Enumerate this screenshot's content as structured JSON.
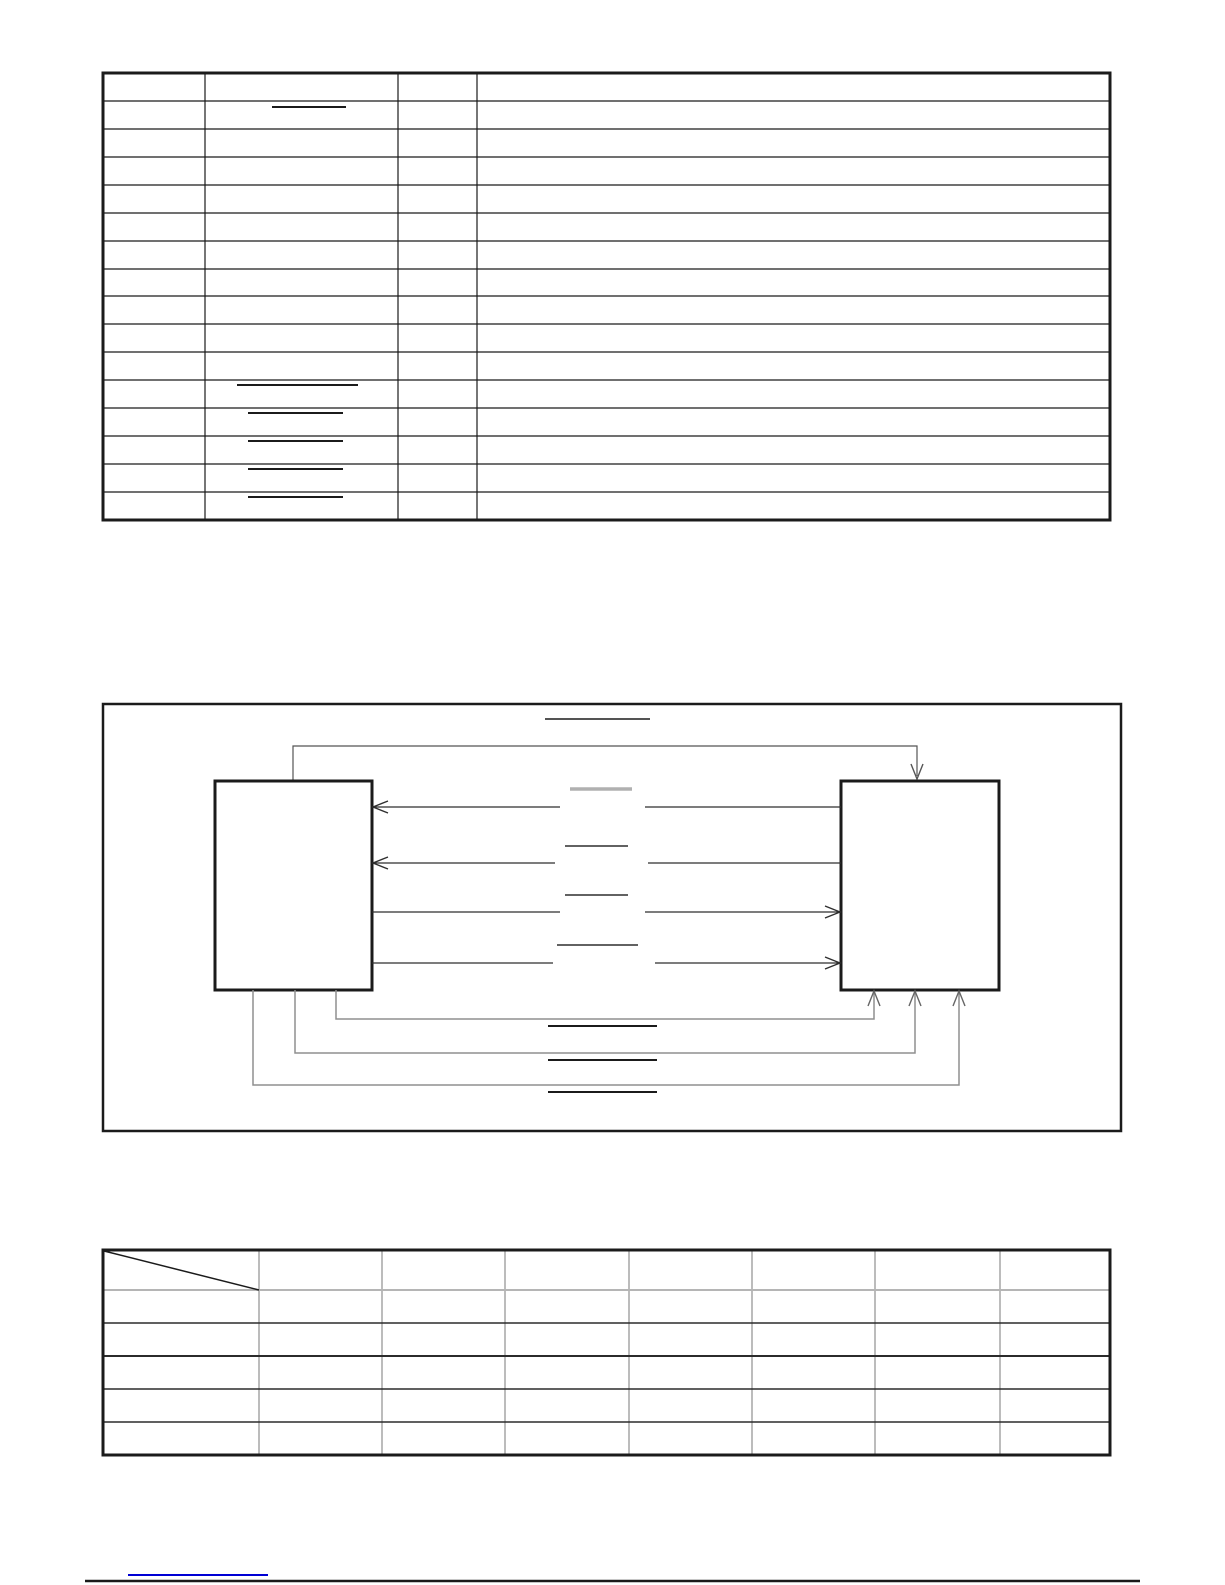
{
  "page": {
    "width": 1225,
    "height": 1585,
    "background": "#ffffff",
    "ink": "#1b1b1b",
    "gray": "#8f8f8f",
    "light_gray": "#b5b5b5",
    "link_blue": "#0000d4"
  },
  "top_table": {
    "name": "top-table",
    "x1": 103,
    "y1": 73,
    "x2": 1110,
    "y2": 520,
    "border_width": 3,
    "grid_width": 1.2,
    "col_edges": [
      103,
      205,
      398,
      477,
      1110
    ],
    "row_edges": [
      73,
      101,
      129,
      157,
      185,
      213,
      241,
      269,
      296,
      324,
      352,
      380,
      408,
      436,
      464,
      492,
      520
    ],
    "overline_marks": [
      {
        "x1": 272,
        "x2": 346,
        "y": 107
      },
      {
        "x1": 237,
        "x2": 358,
        "y": 385
      },
      {
        "x1": 248,
        "x2": 343,
        "y": 413
      },
      {
        "x1": 248,
        "x2": 343,
        "y": 441
      },
      {
        "x1": 248,
        "x2": 343,
        "y": 469
      },
      {
        "x1": 248,
        "x2": 343,
        "y": 497
      }
    ]
  },
  "diagram": {
    "name": "block-diagram",
    "frame": {
      "x1": 103,
      "y1": 704,
      "x2": 1121,
      "y2": 1131,
      "stroke_width": 2.5
    },
    "title_underline": {
      "x1": 545,
      "x2": 650,
      "y": 719,
      "width": 1.5
    },
    "left_block": {
      "x1": 215,
      "y1": 781,
      "x2": 372,
      "y2": 990,
      "stroke_width": 3
    },
    "right_block": {
      "x1": 841,
      "y1": 781,
      "x2": 999,
      "y2": 990,
      "stroke_width": 3
    },
    "top_connector": {
      "color": "#555555",
      "points": [
        [
          293,
          781
        ],
        [
          293,
          746
        ],
        [
          917,
          746
        ],
        [
          917,
          776
        ]
      ],
      "arrow": {
        "x": 917,
        "y": 779,
        "dir": "down"
      }
    },
    "signal_lines": [
      {
        "color": "#2f2f2f",
        "segments": [
          [
            [
              560,
              807
            ],
            [
              372,
              807
            ]
          ],
          [
            [
              841,
              807
            ],
            [
              645,
              807
            ]
          ]
        ],
        "arrow": {
          "x": 373,
          "y": 807,
          "dir": "left"
        },
        "label_line": {
          "x1": 570,
          "x2": 632,
          "y": 789,
          "width": 3.5,
          "color": "#b0b0b0"
        }
      },
      {
        "color": "#2f2f2f",
        "segments": [
          [
            [
              555,
              863
            ],
            [
              372,
              863
            ]
          ],
          [
            [
              841,
              863
            ],
            [
              648,
              863
            ]
          ]
        ],
        "arrow": {
          "x": 373,
          "y": 863,
          "dir": "left"
        },
        "label_line": {
          "x1": 565,
          "x2": 628,
          "y": 846,
          "width": 1.5,
          "color": "#2f2f2f"
        }
      },
      {
        "color": "#2f2f2f",
        "segments": [
          [
            [
              372,
              912
            ],
            [
              560,
              912
            ]
          ],
          [
            [
              645,
              912
            ],
            [
              841,
              912
            ]
          ]
        ],
        "arrow": {
          "x": 840,
          "y": 912,
          "dir": "right"
        },
        "label_line": {
          "x1": 565,
          "x2": 628,
          "y": 895,
          "width": 1.5,
          "color": "#2f2f2f"
        }
      },
      {
        "color": "#2f2f2f",
        "segments": [
          [
            [
              372,
              963
            ],
            [
              553,
              963
            ]
          ],
          [
            [
              655,
              963
            ],
            [
              841,
              963
            ]
          ]
        ],
        "arrow": {
          "x": 840,
          "y": 963,
          "dir": "right"
        },
        "label_line": {
          "x1": 557,
          "x2": 638,
          "y": 945,
          "width": 1.5,
          "color": "#2f2f2f"
        }
      }
    ],
    "bottom_connectors": [
      {
        "color": "#8f8f8f",
        "points": [
          [
            336,
            990
          ],
          [
            336,
            1019
          ],
          [
            874,
            1019
          ],
          [
            874,
            993
          ]
        ],
        "arrow": {
          "x": 874,
          "y": 991,
          "dir": "up"
        },
        "label_line": {
          "x1": 548,
          "x2": 657,
          "y": 1026,
          "width": 2,
          "color": "#1b1b1b"
        }
      },
      {
        "color": "#8f8f8f",
        "points": [
          [
            295,
            990
          ],
          [
            295,
            1053
          ],
          [
            915,
            1053
          ],
          [
            915,
            993
          ]
        ],
        "arrow": {
          "x": 915,
          "y": 991,
          "dir": "up"
        },
        "label_line": {
          "x1": 548,
          "x2": 657,
          "y": 1060,
          "width": 2,
          "color": "#1b1b1b"
        }
      },
      {
        "color": "#8f8f8f",
        "points": [
          [
            253,
            990
          ],
          [
            253,
            1085
          ],
          [
            959,
            1085
          ],
          [
            959,
            993
          ]
        ],
        "arrow": {
          "x": 959,
          "y": 991,
          "dir": "up"
        },
        "label_line": {
          "x1": 548,
          "x2": 657,
          "y": 1092,
          "width": 2,
          "color": "#1b1b1b"
        }
      }
    ]
  },
  "bottom_table": {
    "name": "bottom-table",
    "x1": 103,
    "y1": 1250,
    "x2": 1110,
    "y2": 1455,
    "border_width": 3,
    "grid_width": 1.2,
    "grid_color": "#8f8f8f",
    "col_edges": [
      103,
      259,
      382,
      505,
      629,
      752,
      875,
      1000,
      1110
    ],
    "row_edges": [
      1250,
      1290,
      1323,
      1356,
      1389,
      1422,
      1455
    ],
    "row_colors": [
      "#b5b5b5",
      "#2b2b2b",
      "#2b2b2b",
      "#2b2b2b",
      "#2b2b2b"
    ],
    "row_widths": [
      2,
      1.5,
      2,
      1.5,
      1.5
    ],
    "diagonal": {
      "x1": 104,
      "y1": 1251,
      "x2": 259,
      "y2": 1290
    }
  },
  "footer": {
    "link_underline": {
      "x1": 128,
      "x2": 268,
      "y": 1574,
      "width": 2
    },
    "rule": {
      "x1": 85,
      "x2": 1140,
      "y": 1581,
      "width": 2.5,
      "color": "#1b1b1b"
    }
  }
}
